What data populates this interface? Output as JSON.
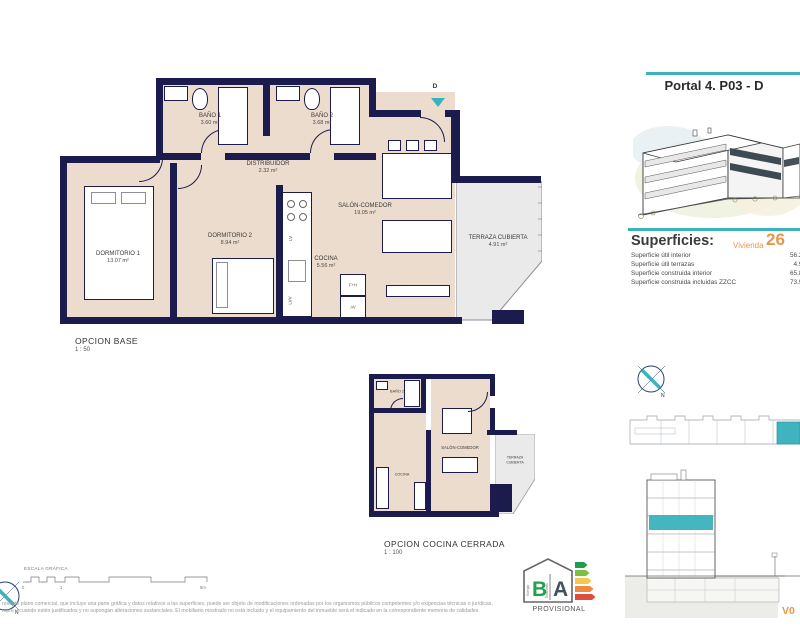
{
  "colors": {
    "navy": "#1b1b4d",
    "beige": "#ecdccd",
    "teal": "#3ab3be",
    "orange": "#e8964a",
    "gray": "#eaeaea"
  },
  "right_panel": {
    "title": "Portal 4. P03 - D",
    "superficies": {
      "heading": "Superficies:",
      "vivienda_label": "Vivienda",
      "vivienda_number": "26",
      "rows": [
        {
          "label": "Superficie útil interior",
          "value": "56.21"
        },
        {
          "label": "Superficie útil terrazas",
          "value": "4.91"
        },
        {
          "label": "Superficie construida interior",
          "value": "65.88"
        },
        {
          "label": "Superficie construida incluidas ZZCC",
          "value": "73.99"
        }
      ]
    },
    "compass_north": "N",
    "version": "V0"
  },
  "main_plan": {
    "caption": "OPCION BASE",
    "scale": "1 : 50",
    "entrance_label": "D",
    "rooms": [
      {
        "name": "BAÑO 1",
        "area": "3.60 m²"
      },
      {
        "name": "BAÑO 2",
        "area": "3.68 m²"
      },
      {
        "name": "DISTRIBUIDOR",
        "area": "2.32 m²"
      },
      {
        "name": "DORMITORIO 1",
        "area": "13.07 m²"
      },
      {
        "name": "DORMITORIO 2",
        "area": "8.94 m²"
      },
      {
        "name": "SALÓN-COMEDOR",
        "area": "19.05 m²"
      },
      {
        "name": "COCINA",
        "area": "5.56 m²"
      },
      {
        "name": "TERRAZA CUBIERTA",
        "area": "4.91 m²"
      }
    ],
    "appliances": {
      "lv": "LV",
      "fh": "F+H",
      "av": "AV",
      "lvv": "LVV"
    }
  },
  "small_plan": {
    "caption": "OPCION COCINA CERRADA",
    "scale": "1 : 100",
    "rooms": [
      {
        "name": "BAÑO 2"
      },
      {
        "name": "SALÓN-COMEDOR"
      },
      {
        "name": "COCINA"
      },
      {
        "name": "TERRAZA CUBIERTA"
      }
    ]
  },
  "scale_bar": {
    "label": "ESCALA GRÁFICA",
    "tick0": "0",
    "tick1": "1",
    "tick5": "5m"
  },
  "footer": {
    "legal_line1": "resente plano comercial, que incluye una parte gráfica y datos relativos a las superficies, puede ser objeto de modificaciones ordenadas por los organismos públicos competentes y/o exigencias técnicas o jurídicas,",
    "legal_line2": "mpre y cuando estén justificados y no supongan alteraciones sustanciales. El mobiliario mostrado no está incluido y el equipamiento del inmueble será el indicado en la correspondiente memoria de calidades"
  },
  "energy_logo": {
    "letter_b": "B",
    "letter_a": "A",
    "word_energia": "Energía",
    "word_emisiones": "Emisiones",
    "caption": "PROVISIONAL"
  }
}
